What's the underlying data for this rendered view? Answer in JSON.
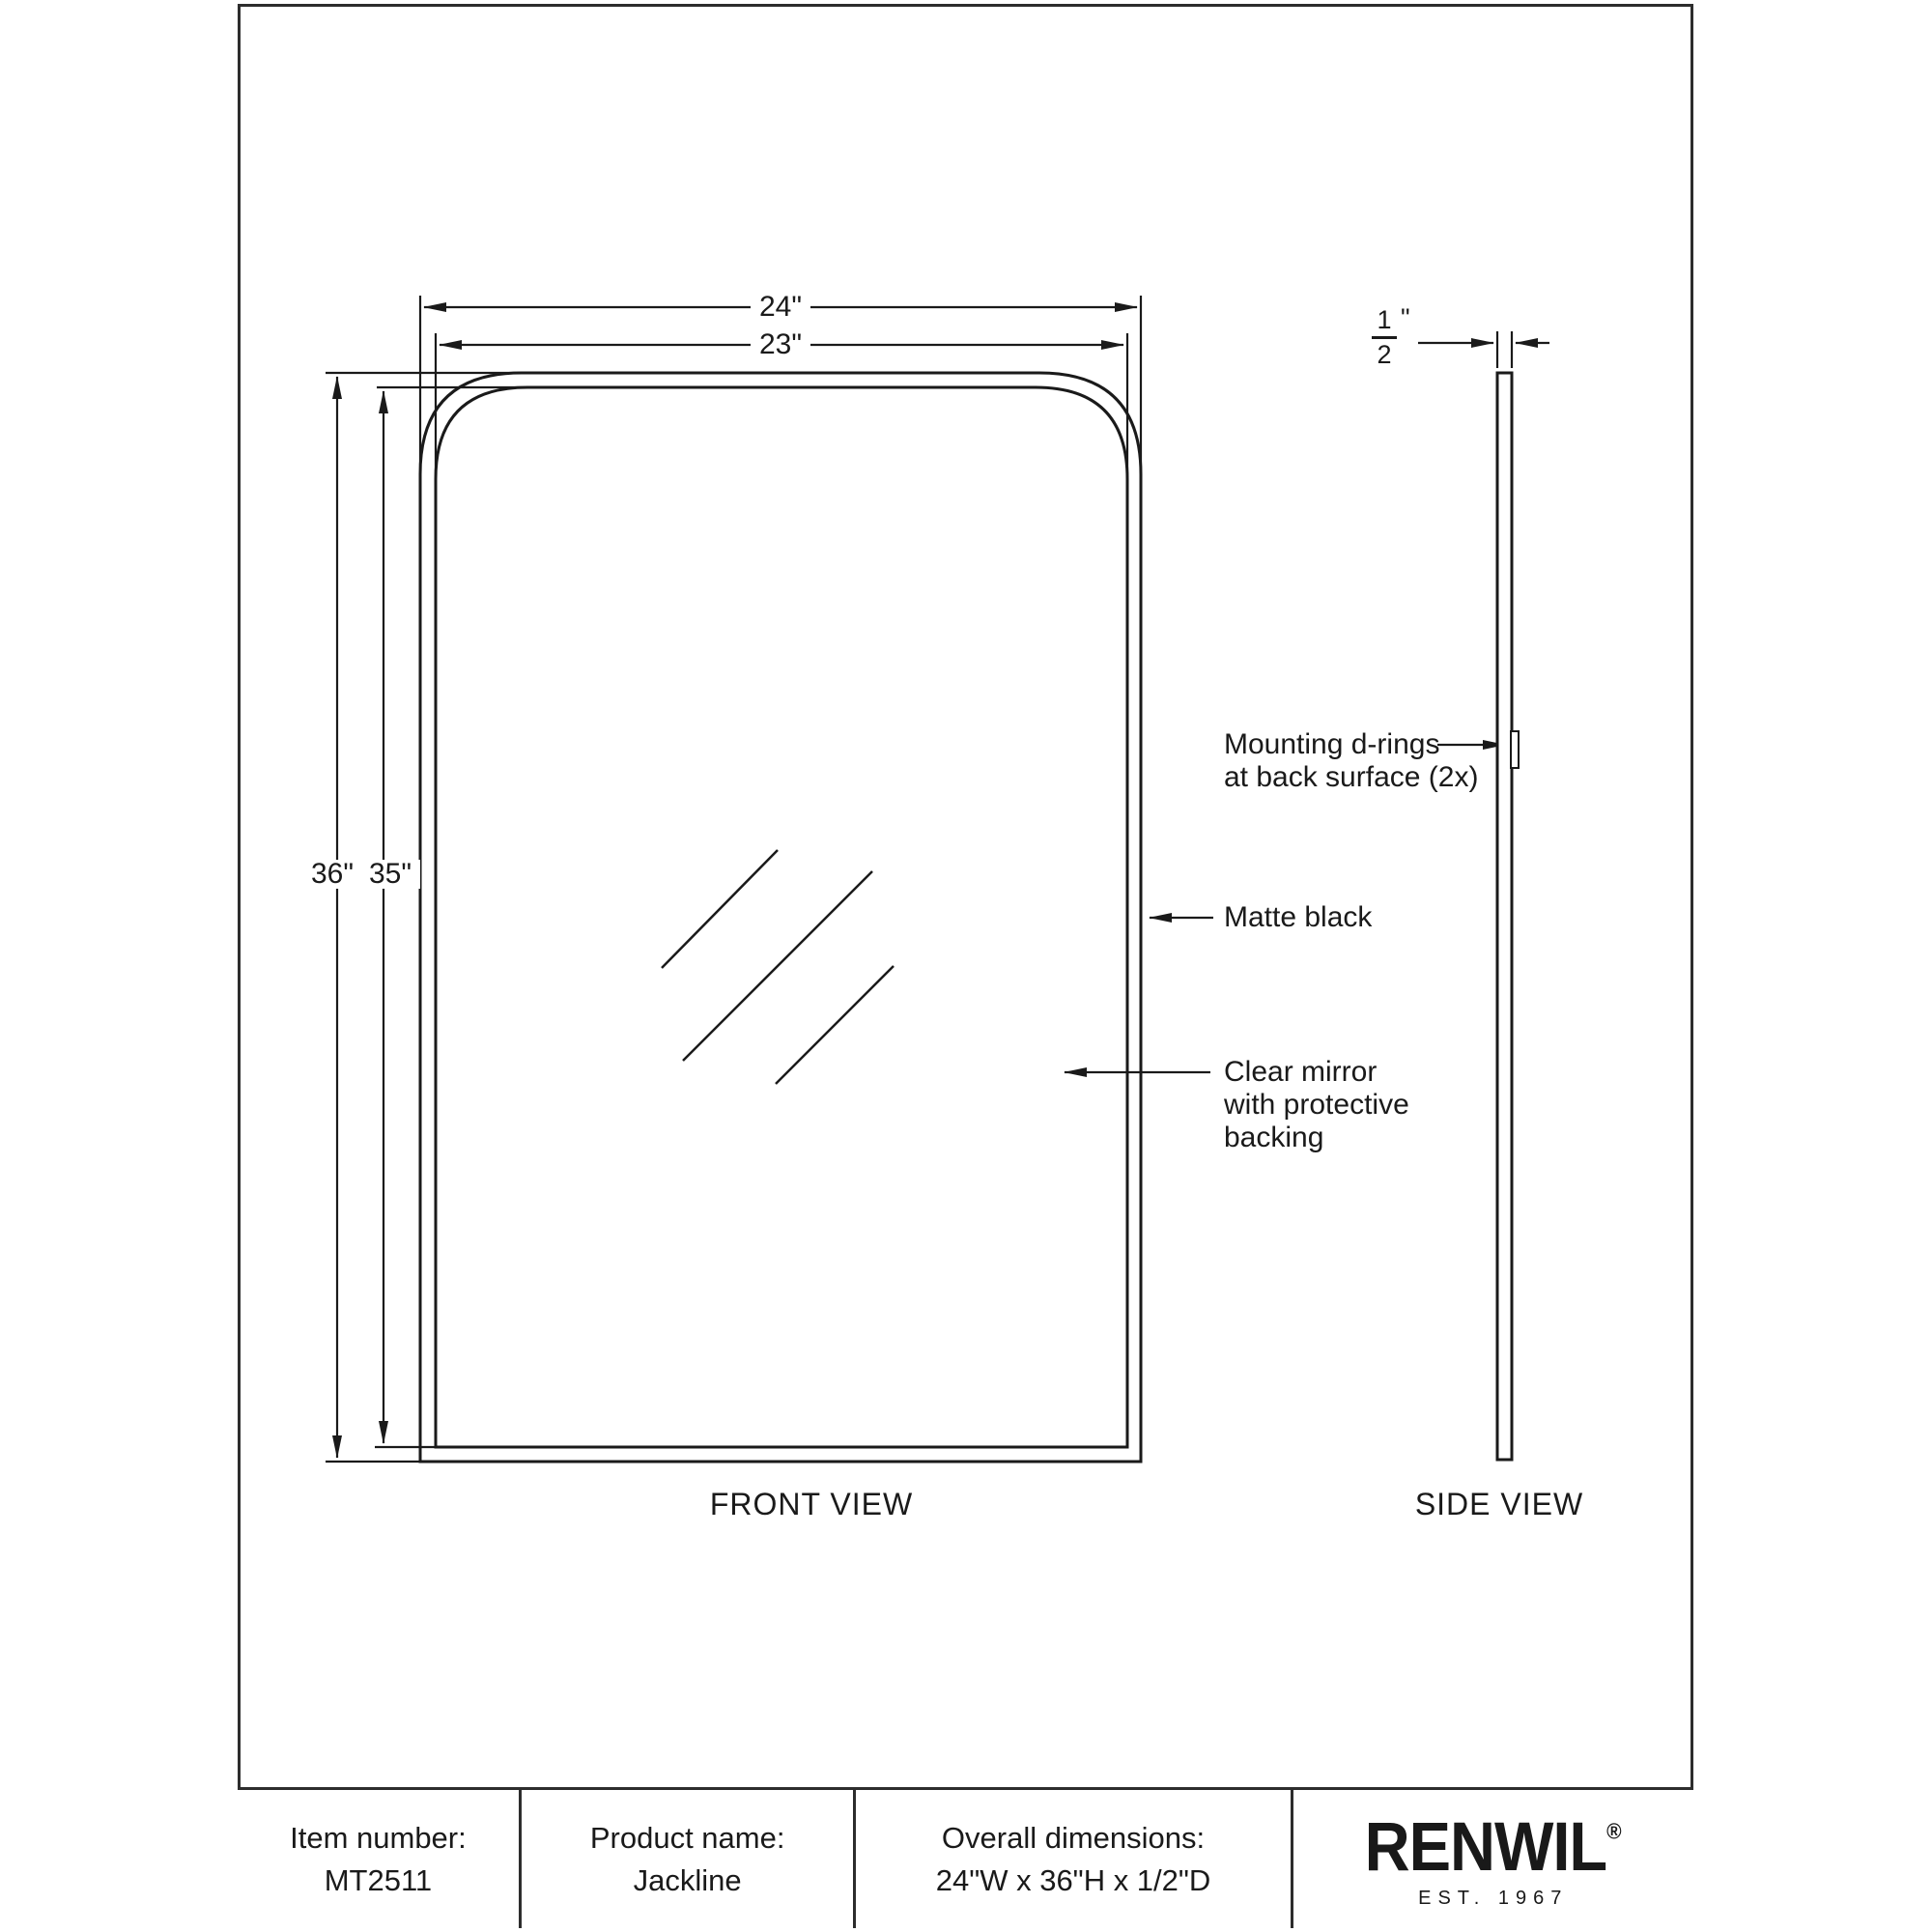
{
  "drawing": {
    "front_view": {
      "label": "FRONT VIEW",
      "dim_width_outer": "24\"",
      "dim_width_inner": "23\"",
      "dim_height_outer": "36\"",
      "dim_height_inner": "35\"",
      "annotations": {
        "mounting_line1": "Mounting d-rings",
        "mounting_line2": "at back surface (2x)",
        "frame_finish": "Matte black",
        "mirror_line1": "Clear mirror",
        "mirror_line2": "with protective",
        "mirror_line3": "backing"
      }
    },
    "side_view": {
      "label": "SIDE VIEW",
      "thickness": {
        "numerator": "1",
        "denominator": "2",
        "unit": "\""
      }
    }
  },
  "title_block": {
    "item": {
      "label": "Item number:",
      "value": "MT2511"
    },
    "product": {
      "label": "Product name:",
      "value": "Jackline"
    },
    "dimensions": {
      "label": "Overall dimensions:",
      "value": "24\"W x 36\"H x 1/2\"D"
    },
    "brand": {
      "name": "RENWIL",
      "registered": "®",
      "est": "EST. 1967"
    }
  },
  "colors": {
    "line": "#1a1a1a",
    "background": "#ffffff"
  }
}
